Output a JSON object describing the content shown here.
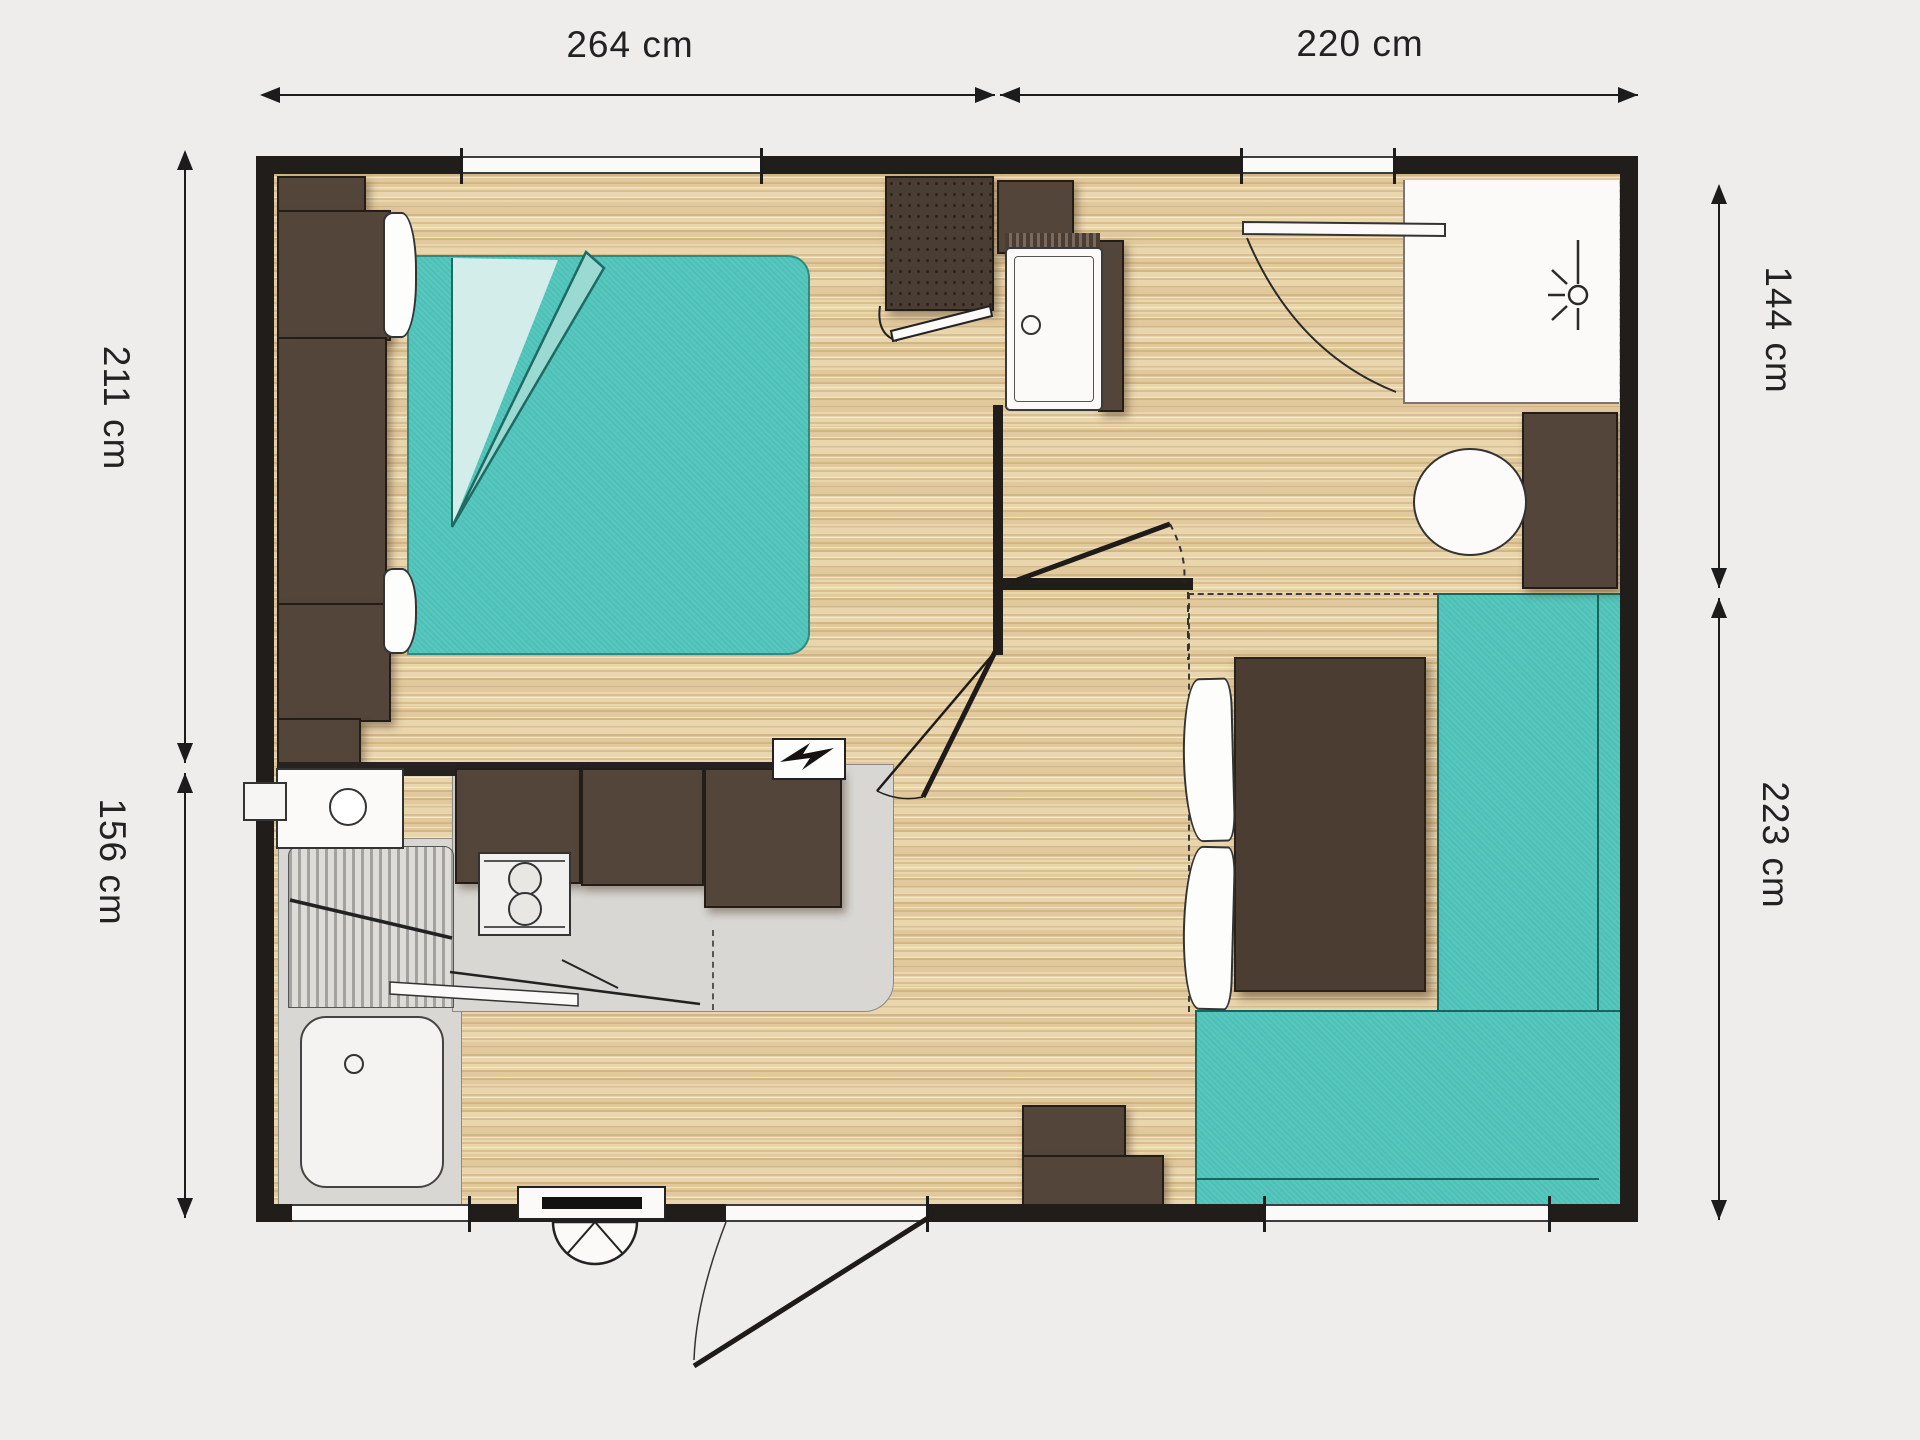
{
  "dimensions": {
    "top_left": "264 cm",
    "top_right": "220 cm",
    "left_top": "211 cm",
    "left_bottom": "156 cm",
    "right_top": "144 cm",
    "right_bottom": "223 cm"
  },
  "colors": {
    "page_background": "#efedec",
    "wall": "#211d1a",
    "floor_wood": "#ead7b0",
    "teal_upholstery": "#4cc1b7",
    "teal_outline": "#17665e",
    "brown_furniture": "#53453a",
    "counter_gray": "#d8d7d3",
    "fixture_white": "#fbfaf8",
    "dimension_text": "#222222"
  },
  "icons": [
    "lightning-bolt-icon",
    "shower-head-icon",
    "entry-step-fan-icon",
    "dimension-arrow-icon"
  ]
}
